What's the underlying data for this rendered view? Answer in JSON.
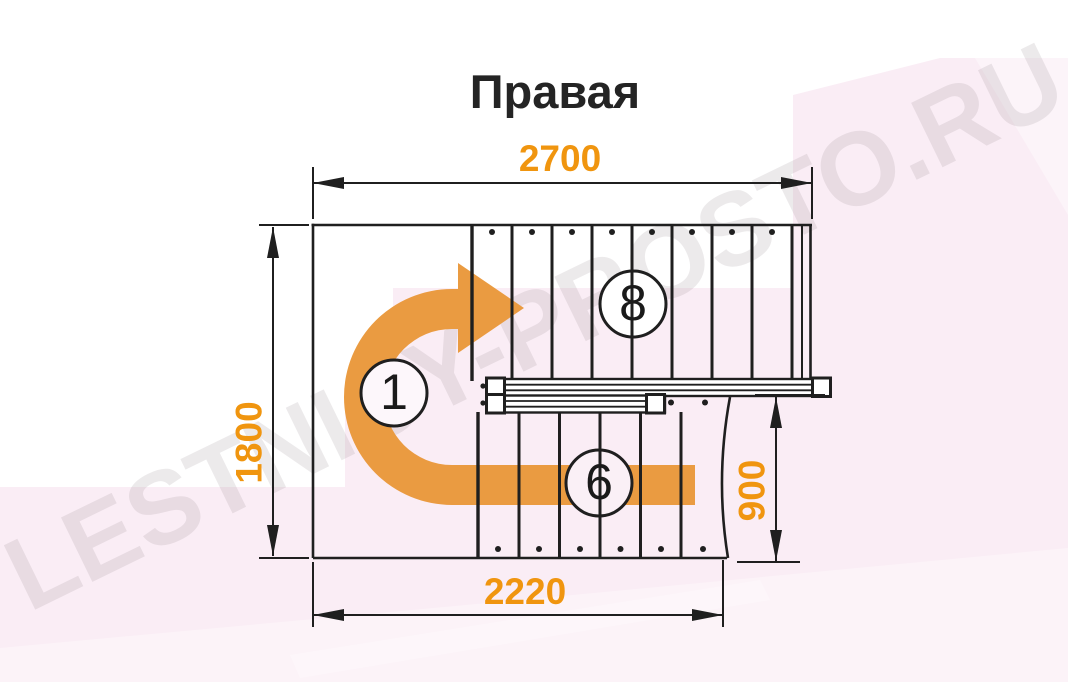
{
  "title": "Правая",
  "watermark": {
    "text": "LESTNICY-PROSTO.RU"
  },
  "dimensions": {
    "top_width_mm": "2700",
    "left_depth_mm": "1800",
    "right_flight_width_mm": "900",
    "bottom_width_mm": "2220"
  },
  "step_labels": {
    "landing": "1",
    "upper_flight": "8",
    "lower_flight": "6"
  },
  "colors": {
    "dimension_orange": "#F0950F",
    "arrow_orange": "#EA9B41",
    "line_black": "#1F1F1F",
    "pink_background": "#FAEDF5",
    "pink_light": "#FCF4F9",
    "title_color": "#242424"
  }
}
